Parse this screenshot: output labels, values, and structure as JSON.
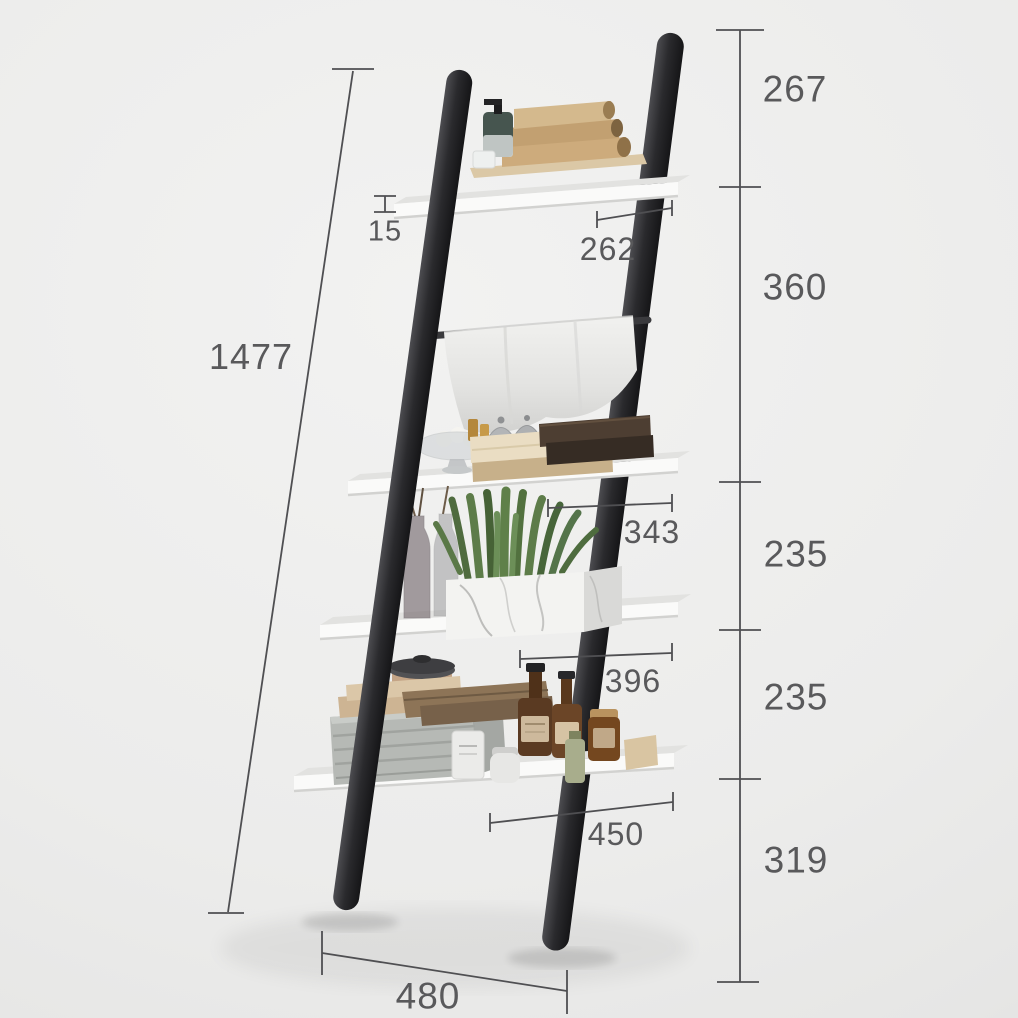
{
  "measurements": {
    "total_height": "1477",
    "right_segments": [
      "267",
      "360",
      "235",
      "235",
      "319"
    ],
    "shelf_thickness": "15",
    "shelf_depths": [
      "262",
      "343",
      "396",
      "450"
    ],
    "base_width": "480"
  },
  "colors": {
    "background": "#ececeb",
    "rail": "#2b2b2e",
    "shelf": "#f8f8f7",
    "dimension_line": "#4f4f52",
    "label_text": "#59595b",
    "hanging_towel": "#e7e7e5",
    "folded_towels": "#c9a878",
    "plant": "#587643",
    "amber_bottle": "#5d3d24",
    "basket": "#b6b9b5"
  },
  "scene_items": {
    "shelf_1": [
      "soap-dispenser",
      "folded-towel-stack",
      "small-cup",
      "wood-tray"
    ],
    "shelf_2": [
      "hanging-towel",
      "glass-bowl",
      "candle-holders",
      "perfume-bottles",
      "folded-towels"
    ],
    "shelf_3": [
      "glass-vases",
      "succulent-plant",
      "marble-planter"
    ],
    "shelf_4": [
      "wicker-basket",
      "leather-pouches",
      "round-canister",
      "amber-bottles",
      "jars"
    ]
  }
}
